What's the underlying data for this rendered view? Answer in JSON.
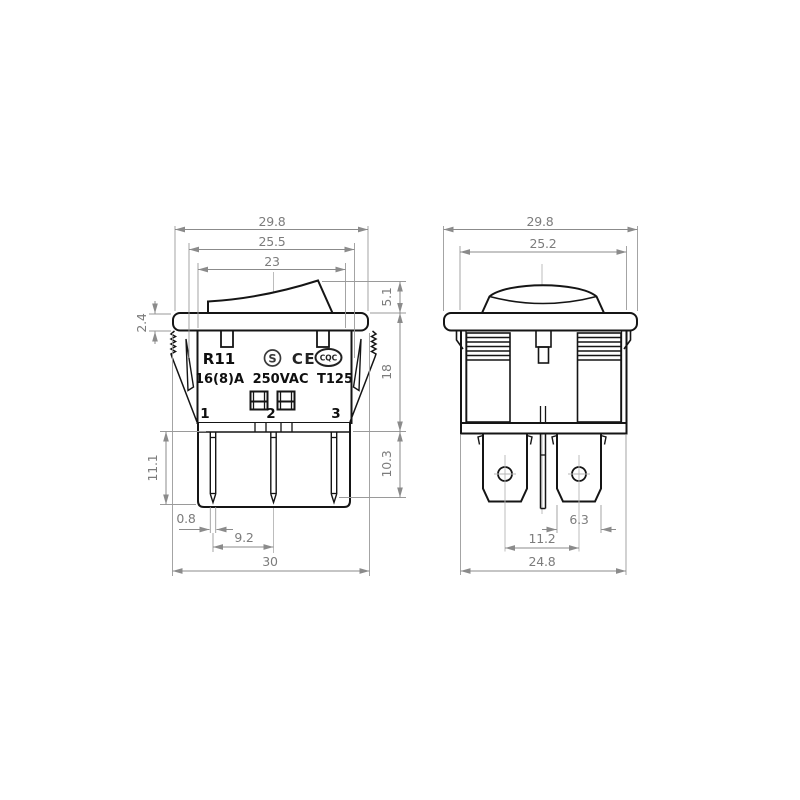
{
  "drawing": {
    "kind": "technical-dimensional-drawing",
    "subject": "rocker switch, two views",
    "colors": {
      "outline": "#151515",
      "dimension": "#8b8b8b",
      "background": "#ffffff"
    },
    "front": {
      "dims": {
        "flange_width": "29.8",
        "latch_width": "25.5",
        "body_width": "23",
        "rocker_height": "5.1",
        "flange_thickness": "2.4",
        "body_depth": "18",
        "terminal_depth": "10.3",
        "pin_length": "11.1",
        "pin_thickness": "0.8",
        "pin_pitch": "9.2",
        "overall_width": "30"
      },
      "markings": {
        "model": "R11",
        "rating": "16(8)A 250VAC T125",
        "cert_s": "S",
        "cert_ce": "CE",
        "cert_cqc": "CQC",
        "terminal_1": "1",
        "terminal_2": "2",
        "terminal_3": "3"
      }
    },
    "side": {
      "dims": {
        "flange_width": "29.8",
        "body_width": "25.2",
        "terminal_width": "6.3",
        "terminal_pitch": "11.2",
        "base_width": "24.8"
      }
    }
  }
}
